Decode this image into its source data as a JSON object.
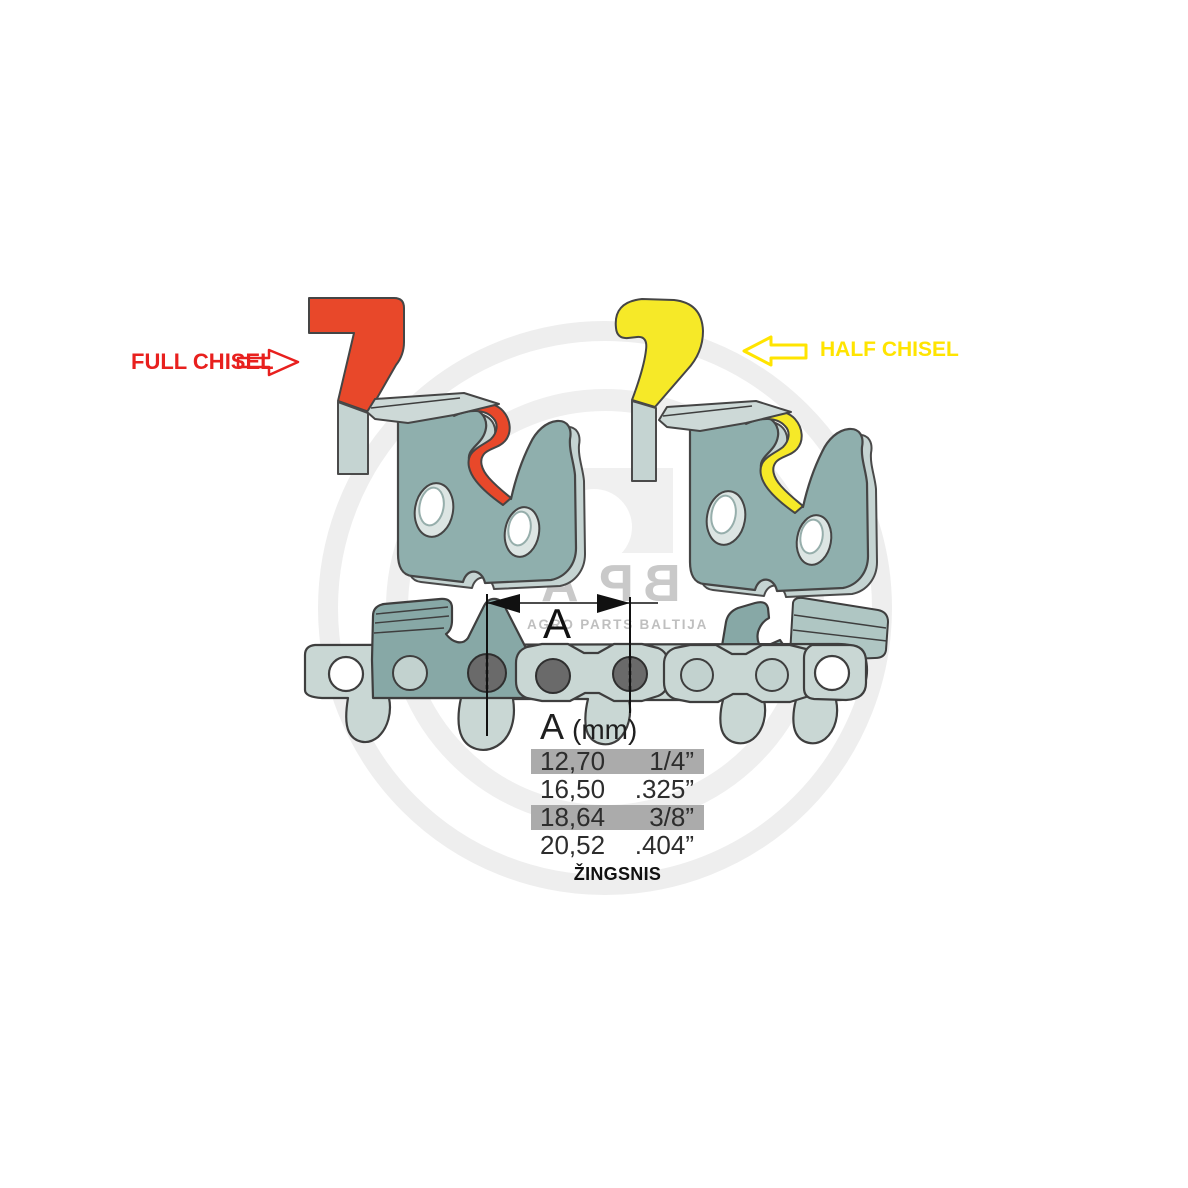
{
  "diagram": {
    "full_chisel_label": "FULL CHISEL",
    "half_chisel_label": "HALF CHISEL",
    "dimension_label": "A",
    "pitch_caption": "ŽINGSNIS"
  },
  "watermark": {
    "logo_letters": [
      "A",
      "P",
      "B"
    ],
    "subtitle": "AGRO PARTS BALTIJA"
  },
  "pitch_table": {
    "header_letter": "A",
    "header_unit": "(mm)",
    "rows": [
      {
        "mm": "12,70",
        "inches": "1/4”",
        "highlighted": true
      },
      {
        "mm": "16,50",
        "inches": ".325”",
        "highlighted": false
      },
      {
        "mm": "18,64",
        "inches": "3/8”",
        "highlighted": true
      },
      {
        "mm": "20,52",
        "inches": ".404”",
        "highlighted": false
      }
    ]
  },
  "colors": {
    "full_chisel_red": "#e8482a",
    "half_chisel_yellow": "#f6e928",
    "label_red": "#e8201e",
    "label_yellow": "#ffe400",
    "cutter_body_teal": "#8fafad",
    "cutter_side_light": "#c5d4d2",
    "chain_strap_light": "#c9d7d4",
    "rivet_dark_gray": "#6a6a6a",
    "table_highlight_gray": "#ababab",
    "watermark_gray": "#c9c9c9"
  }
}
